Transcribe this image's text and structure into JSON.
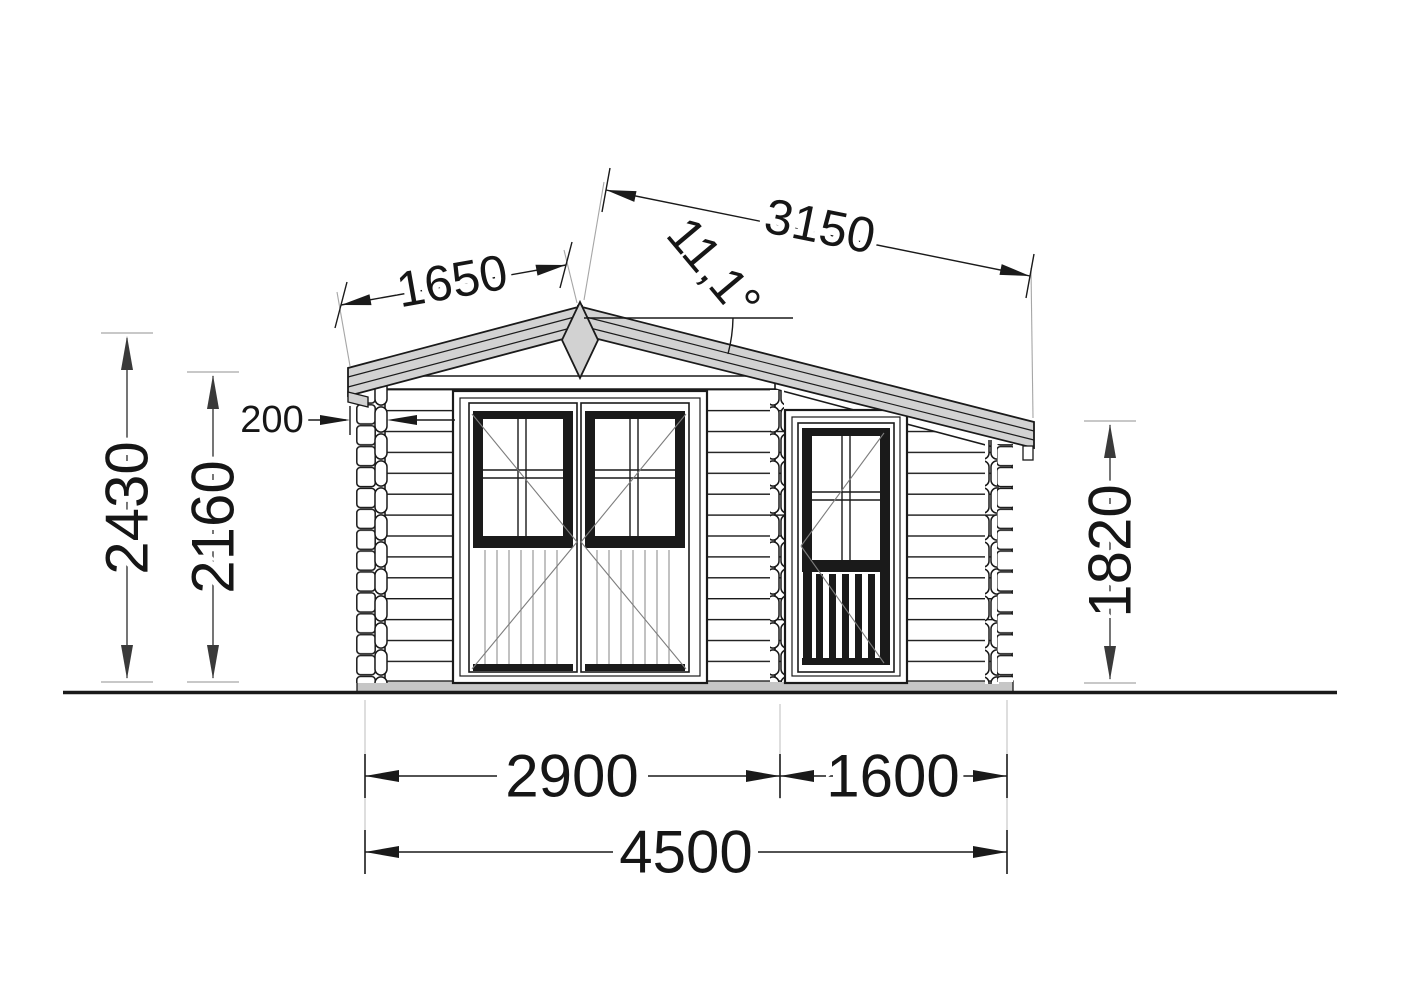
{
  "drawing": {
    "type": "front-elevation",
    "subject": "log cabin garden house"
  },
  "dimensions": {
    "roof_slope_left": "1650",
    "roof_slope_right": "3150",
    "roof_angle": "11,1°",
    "roof_overhang": "200",
    "ridge_height": "2430",
    "eaves_height_left": "2160",
    "eaves_height_right": "1820",
    "main_section_width": "2900",
    "side_section_width": "1600",
    "total_width": "4500"
  },
  "colors": {
    "line": "#1a1a1a",
    "fascia_fill": "#d2d2d2",
    "base_fill": "#c6c6c6",
    "extension_line": "#a6a6a6",
    "swing_line": "#7d7d7d",
    "plank_line": "#9a9a9a"
  }
}
